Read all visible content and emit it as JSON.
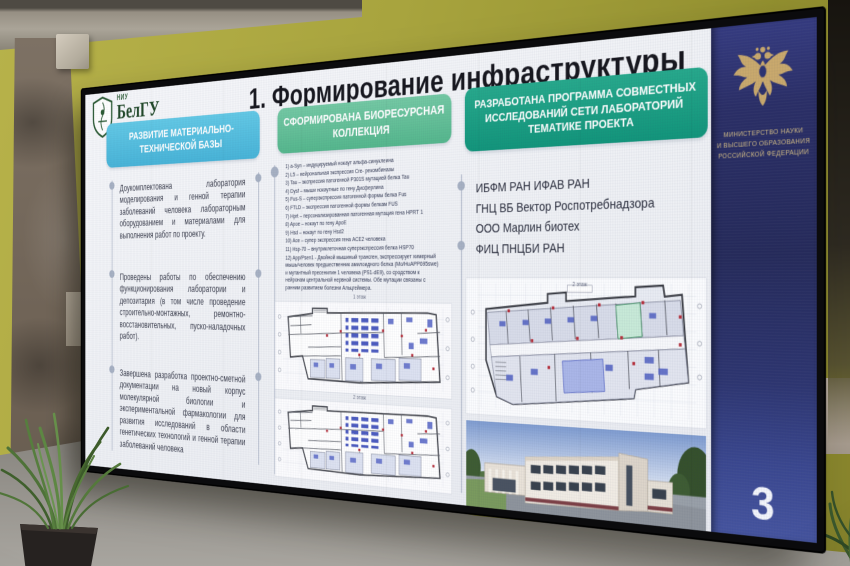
{
  "photo": {
    "page_number": "3"
  },
  "logo": {
    "niu": "НИУ",
    "name": "БелГУ",
    "subtitle": "BELGOROD STATE UNIVERSITY (BSU)"
  },
  "slide": {
    "title": "1. Формирование инфраструктуры",
    "col1": {
      "header": "РАЗВИТИЕ МАТЕРИАЛЬНО-ТЕХНИЧЕСКОЙ БАЗЫ",
      "bullets": [
        "Доукомплектована лаборатория моделирования и генной терапии заболеваний человека лабораторным оборудованием и материалами для выполнения работ по проекту.",
        "Проведены работы по обеспечению функционирования лаборатории и депозитария (в том числе проведение строительно-монтажных, ремонтно- восстановительных, пуско-наладочных работ).",
        "Завершена разработка проектно-сметной документации на новый корпус молекулярной биологии и экспериментальной фармакологии для развития исследований в области генетических технологий и генной терапии заболеваний человека"
      ]
    },
    "col2": {
      "header": "СФОРМИРОВАНА БИОРЕСУРСНАЯ КОЛЛЕКЦИЯ",
      "items": [
        "1) a-Syn – индуцируемый нокаут альфа-синуклеина",
        "2) L5 – нейрональная экспрессия Cre- рекомбиназы",
        "3) Tau – экспрессия патогенной P301S мутацией белка Tau",
        "4) Dysf – мыши нокаутные по гену Дисферлина",
        "5) Fus-S – суперэкспрессия патогенной формы белка Fus",
        "6) FTLD – экспрессия патогенной формы белкам FUS",
        "7) Hprt – персонализированная патогенная мутация гена HPRT 1",
        "8) Apoe – нокаут по гену ApoE",
        "9) Hsd – нокаут по гену Hsd2",
        "10) Ace – супер экспрессия гена ACE2 человека",
        "11) Hsp-70 – внутриклеточная суперэкспрессия белка HSP70",
        "12) App/Psen1 - Двойной мышиный трансген, экспрессирует химерный мышь/человек предшественник амилоидного белка (Mo/HuAPP695swe) и мутантный пресенилин 1 человека (PS1-dE9), со сродством к нейронам центральной нервной системы. Обе мутации связаны с ранним развитием болезни Альцгеймера."
      ],
      "plan1_caption": "1 этаж",
      "plan2_caption": "2 этаж"
    },
    "col3": {
      "header": "РАЗРАБОТАНА ПРОГРАММА СОВМЕСТНЫХ ИССЛЕДОВАНИЙ СЕТИ ЛАБОРАТОРИЙ ТЕМАТИКЕ ПРОЕКТА",
      "orgs": [
        "ИБФМ РАН ИФАВ РАН",
        "ГНЦ ВБ Вектор Роспотребнадзора",
        "ООО Марлин биотех",
        "ФИЦ ПНЦБИ РАН"
      ],
      "plan_caption": "2 этаж"
    }
  },
  "ministry": {
    "line1": "МИНИСТЕРСТВО НАУКИ",
    "line2": "И ВЫСШЕГО ОБРАЗОВАНИЯ",
    "line3": "РОССИЙСКОЙ ФЕДЕРАЦИИ"
  },
  "colors": {
    "header_blue": "#54c0e0",
    "header_green": "#63c09a",
    "header_teal": "#17997e",
    "ministry_navy": "#2c3170",
    "page_blue": "#45549f",
    "gold": "#c9a96d",
    "wall_olive": "#a8a43e"
  }
}
